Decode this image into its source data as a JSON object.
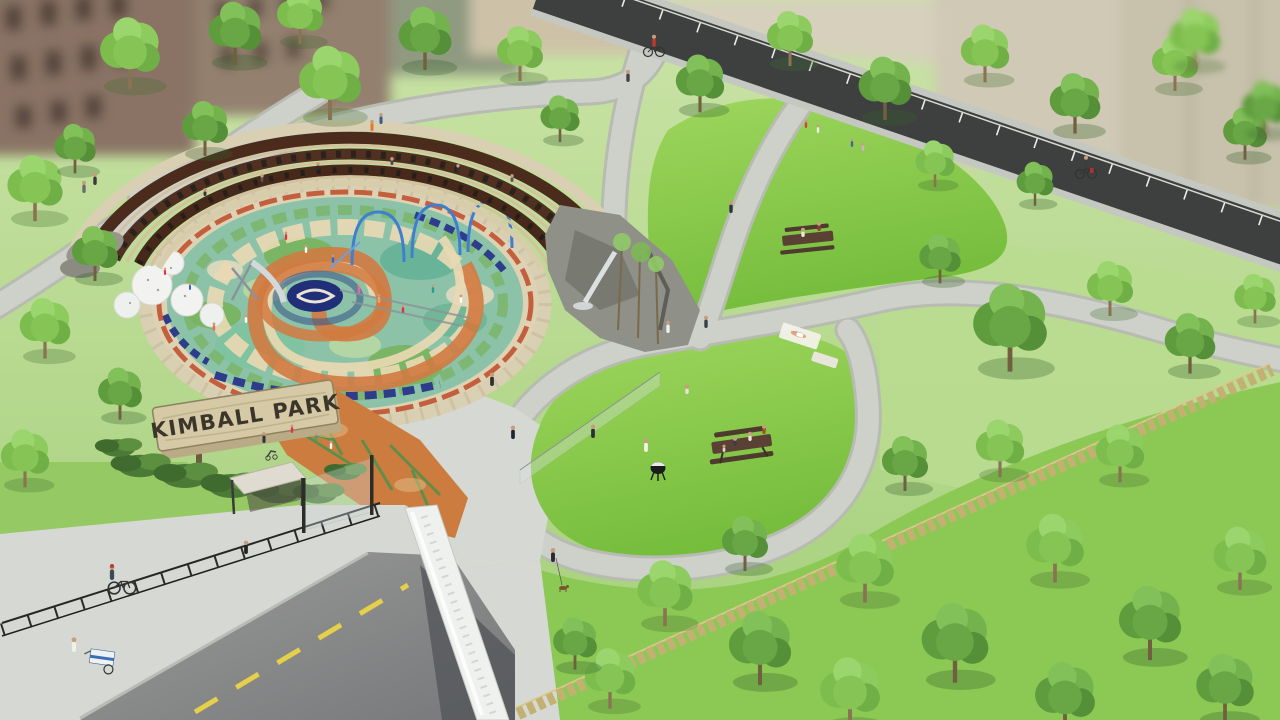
{
  "sign": {
    "text": "KIMBALL PARK"
  },
  "palette": {
    "bg_green": "#a3cf79",
    "bg_green_light": "#cae3a6",
    "grass_bright": "#9ed65e",
    "grass_deep": "#76bd3c",
    "grass_pale": "#b9dc90",
    "foliage_light": "#9bd56d",
    "foliage_mid": "#7cbd4e",
    "foliage_dark": "#5f9c3d",
    "path_gray": "#ced1ca",
    "path_edge": "#b7bbb1",
    "bikepath_dark": "#3e4040",
    "road_gray": "#9a9b99",
    "road_dark": "#77787a",
    "sidewalk_gray": "#d6d8d3",
    "bridge_white": "#eff1ee",
    "yellow_line": "#e6cf4a",
    "amphi_brown": "#4b2b1c",
    "stone_tan": "#d9cfb2",
    "rock_gray": "#8f9088",
    "boulder_white": "#f2f3f0",
    "mosaic_teal": "#8cc3a8",
    "mosaic_green": "#76b35a",
    "mosaic_orange": "#d27a40",
    "mosaic_cream": "#ead9b2",
    "mosaic_red": "#c0522f",
    "mosaic_navy": "#2e3c8c",
    "water_blue": "#3f7fd0",
    "sign_wood": "#d5c9a6",
    "sign_text": "#3c362a",
    "fence_black": "#262626",
    "fence_wood": "#c3b173",
    "trunk_brown": "#8a7353",
    "building_brick": "#8a7365",
    "building_beige": "#d0c9b5",
    "shrub_dark": "#3f6b2e",
    "skin": "#c89c7c",
    "blanket_white": "#f2f1ea"
  }
}
